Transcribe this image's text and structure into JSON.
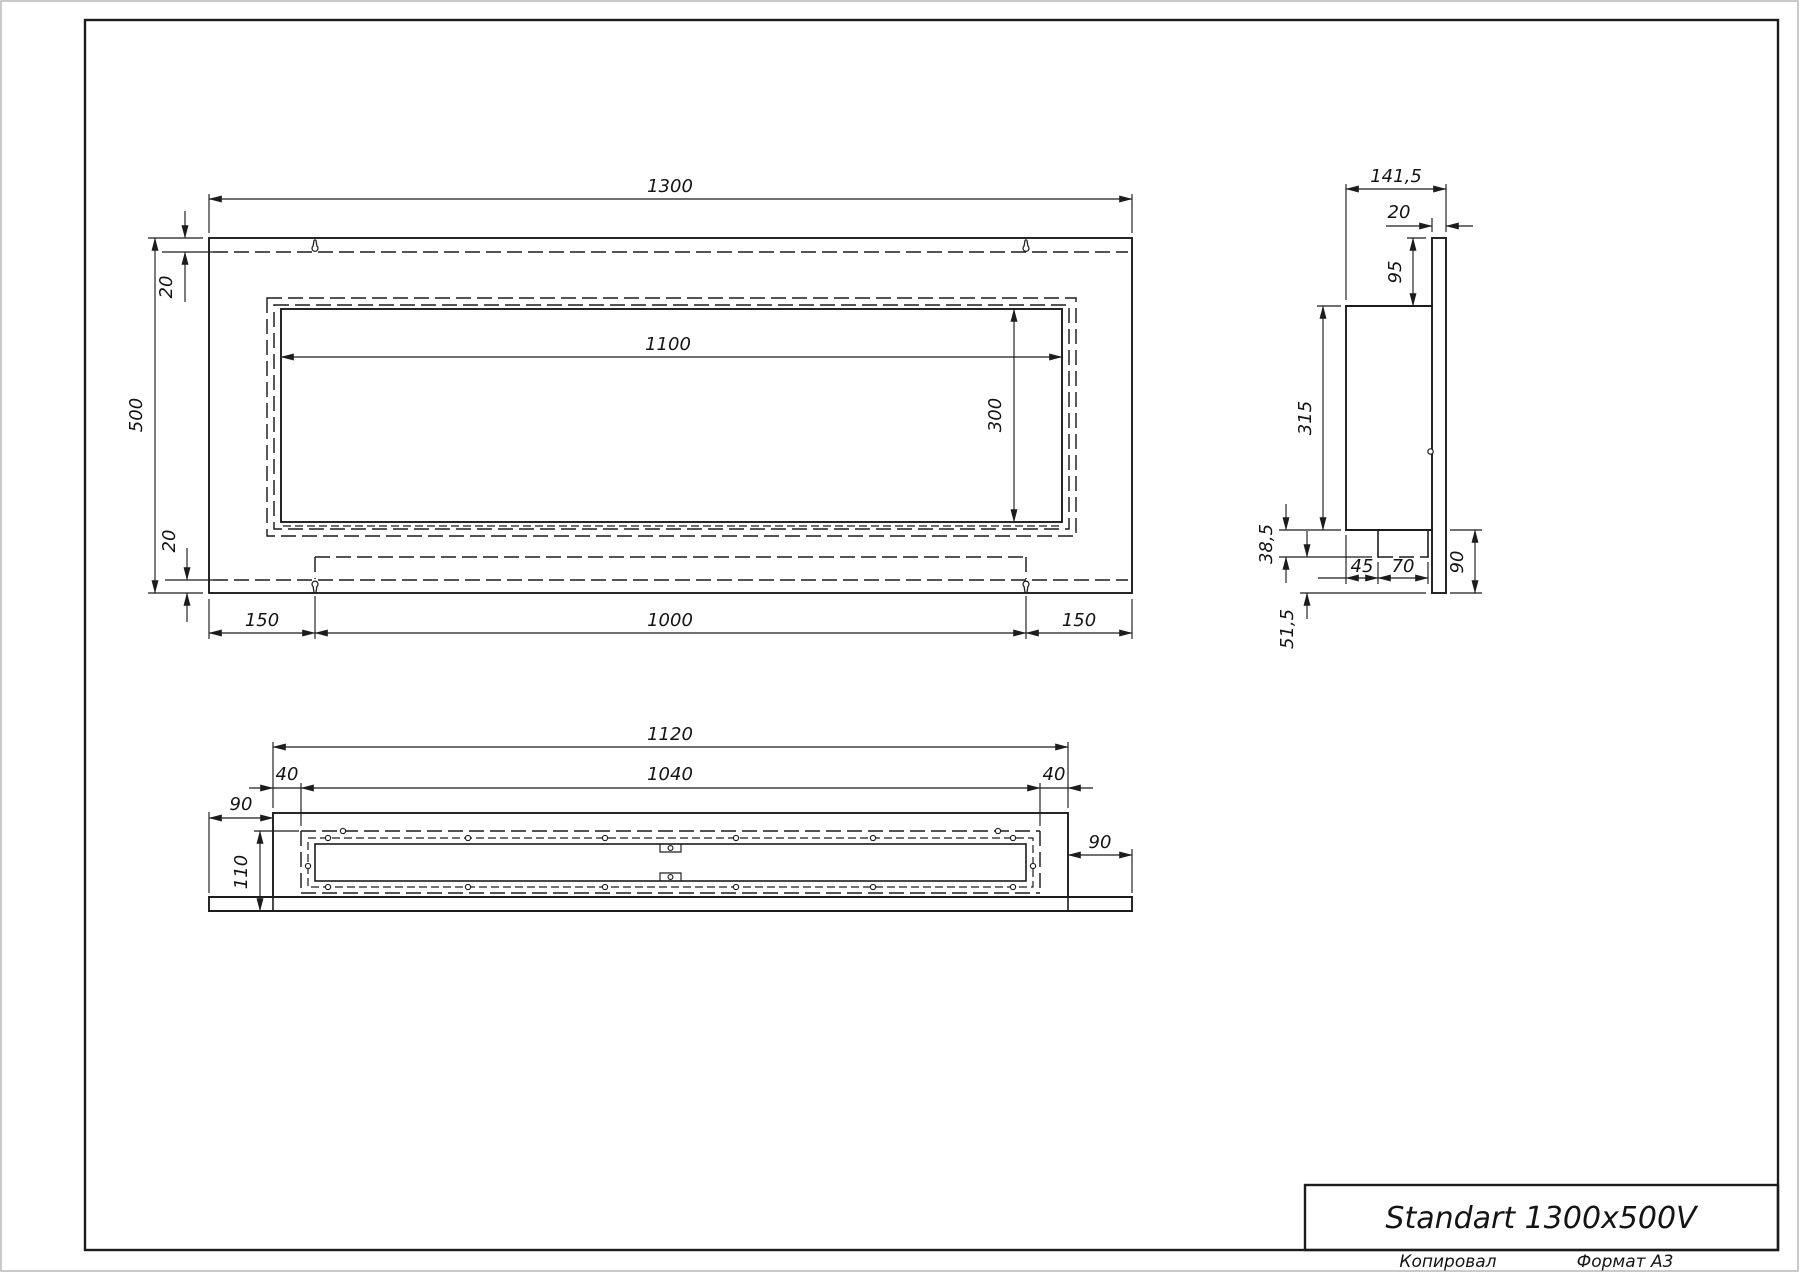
{
  "drawing": {
    "front_view": {
      "overall_width": "1300",
      "overall_height": "500",
      "top_inset": "20",
      "bottom_inset": "20",
      "opening_width": "1100",
      "opening_height": "300",
      "slot_left_offset": "150",
      "slot_span": "1000",
      "slot_right_offset": "150"
    },
    "side_view": {
      "overall_depth": "141,5",
      "plate_thickness": "20",
      "top_offset": "95",
      "body_height": "315",
      "tray_height": "38,5",
      "tray_offset": "45",
      "tray_depth": "70",
      "bottom_extension": "90",
      "lower_margin": "51,5"
    },
    "bottom_view": {
      "body_width": "1120",
      "opening_width": "1040",
      "inset_left": "40",
      "inset_right": "40",
      "margin_left": "90",
      "margin_right": "90",
      "opening_depth": "110"
    },
    "title_block": {
      "model": "Standart 1300x500V",
      "copied_label": "Копировал",
      "format_label": "Формат А3"
    },
    "colors": {
      "line": "#1c1c1c",
      "paper": "#ffffff"
    }
  }
}
